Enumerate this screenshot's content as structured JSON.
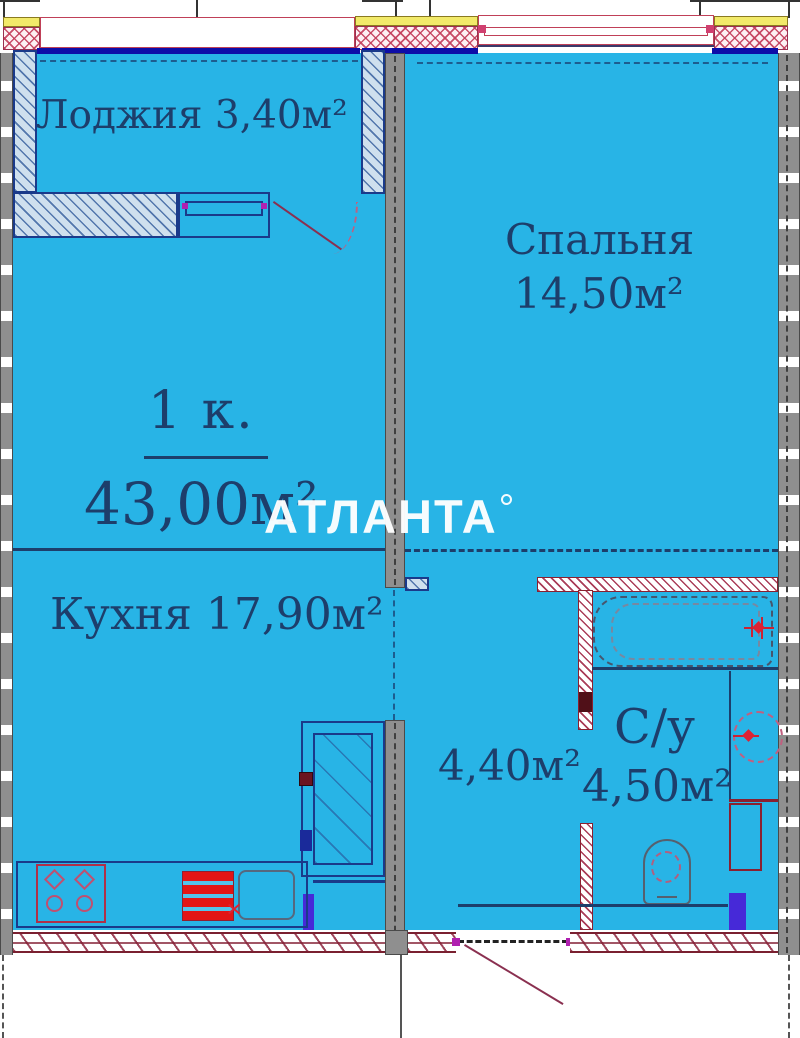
{
  "plan": {
    "type": "apartment-floor-plan",
    "watermark": "АТЛАНТА",
    "rooms": {
      "loggia": {
        "label": "Лоджия 3,40м²"
      },
      "bedroom": {
        "name": "Спальня",
        "area": "14,50м²"
      },
      "apartment": {
        "rooms_label": "1 к.",
        "total_area": "43,00м²"
      },
      "kitchen": {
        "label": "Кухня 17,90м²"
      },
      "hallway": {
        "area": "4,40м²"
      },
      "bathroom": {
        "name": "С/у",
        "area": "4,50м²"
      }
    },
    "colors": {
      "room_fill": "#28b4e6",
      "label_text": "#1d3e6b",
      "wall_gray": "#8f8f8f",
      "column_yellow": "#f2ea6a",
      "hatch_red": "#b03048",
      "wall_top_blue": "#0d0da8",
      "fixture_red": "#e31515",
      "accent_purple": "#4629d8",
      "watermark_white": "#ffffff"
    }
  }
}
